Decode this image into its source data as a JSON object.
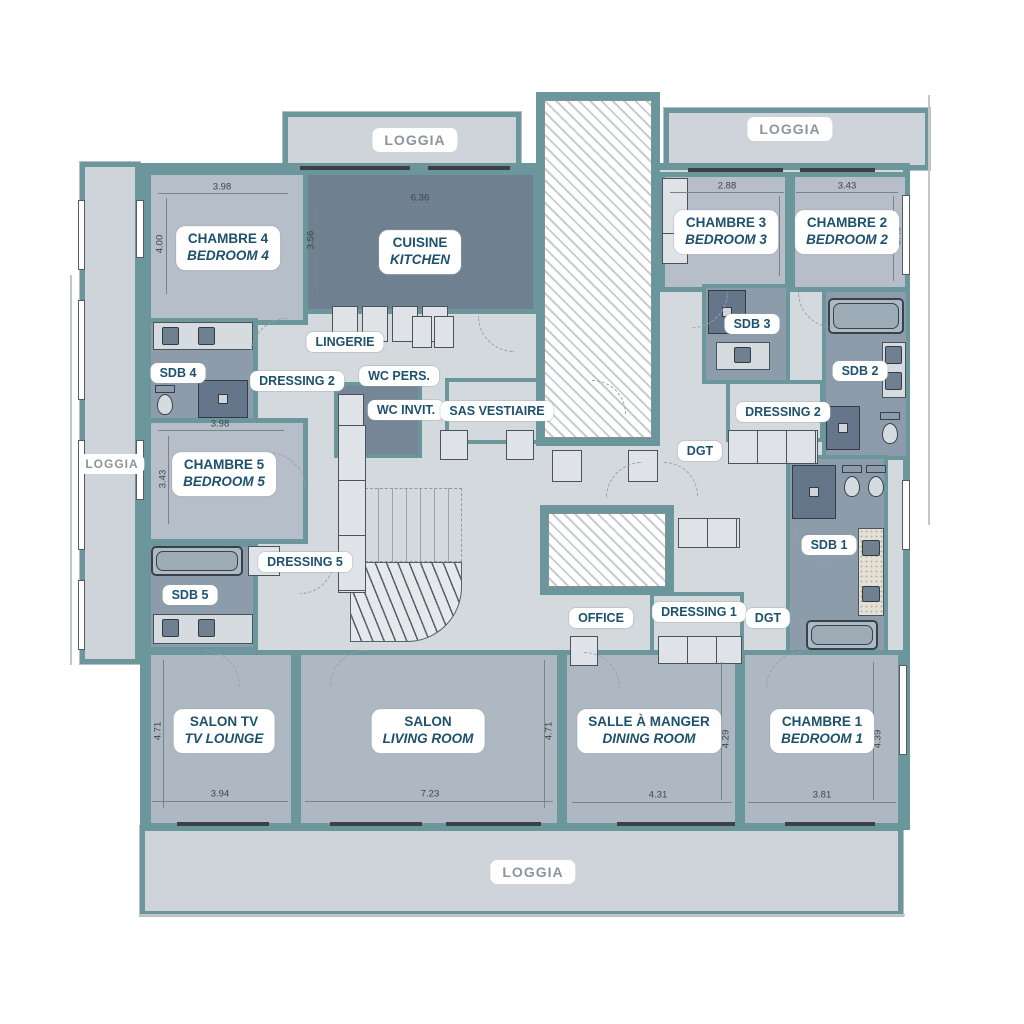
{
  "document": {
    "type": "apartment-floor-plan",
    "languages": "FR/EN"
  },
  "colors": {
    "wall": "#6a969c",
    "floor_corridor": "#d4d9de",
    "floor_bedroom": "#b5bec9",
    "floor_living": "#aeb8c3",
    "floor_kitchen": "#6f8090",
    "floor_bath": "#8d9cab",
    "floor_loggia": "#cfd4da",
    "room_label_text": "#1d516d",
    "loggia_label_text": "#8d949c",
    "dimension_text": "#3f464c"
  },
  "rooms": [
    {
      "id": "chambre-4",
      "name_fr": "CHAMBRE 4",
      "name_en": "BEDROOM 4",
      "width_m": "3.98",
      "height_m": "4.00"
    },
    {
      "id": "cuisine",
      "name_fr": "CUISINE",
      "name_en": "KITCHEN",
      "width_m": "6.36",
      "height_m": "3.56"
    },
    {
      "id": "chambre-3",
      "name_fr": "CHAMBRE 3",
      "name_en": "BEDROOM 3",
      "width_m": "2.88",
      "height_m": "2.80"
    },
    {
      "id": "chambre-2",
      "name_fr": "CHAMBRE 2",
      "name_en": "BEDROOM 2",
      "width_m": "3.43",
      "height_m": "3.40"
    },
    {
      "id": "chambre-5",
      "name_fr": "CHAMBRE 5",
      "name_en": "BEDROOM 5",
      "width_m": "3.98",
      "height_m": "3.43"
    },
    {
      "id": "salon-tv",
      "name_fr": "SALON TV",
      "name_en": "TV LOUNGE",
      "width_m": "3.94",
      "height_m": "4.71"
    },
    {
      "id": "salon",
      "name_fr": "SALON",
      "name_en": "LIVING ROOM",
      "width_m": "7.23",
      "height_m": "4.71"
    },
    {
      "id": "salle-a-manger",
      "name_fr": "SALLE À MANGER",
      "name_en": "DINING ROOM",
      "width_m": "4.31",
      "height_m": "4.29"
    },
    {
      "id": "chambre-1",
      "name_fr": "CHAMBRE 1",
      "name_en": "BEDROOM 1",
      "width_m": "3.81",
      "height_m": "4.39"
    }
  ],
  "service_labels": [
    {
      "label": "SDB 4"
    },
    {
      "label": "DRESSING 2"
    },
    {
      "label": "LINGERIE"
    },
    {
      "label": "WC PERS."
    },
    {
      "label": "WC INVIT."
    },
    {
      "label": "SAS VESTIAIRE"
    },
    {
      "label": "SDB 3"
    },
    {
      "label": "SDB 2"
    },
    {
      "label": "DRESSING 2"
    },
    {
      "label": "DGT"
    },
    {
      "label": "DRESSING 5"
    },
    {
      "label": "SDB 5"
    },
    {
      "label": "SDB 1"
    },
    {
      "label": "OFFICE"
    },
    {
      "label": "DRESSING 1"
    },
    {
      "label": "DGT"
    }
  ],
  "loggia_labels": [
    {
      "label": "LOGGIA"
    },
    {
      "label": "LOGGIA"
    },
    {
      "label": "LOGGIA"
    },
    {
      "label": "LOGGIA"
    }
  ],
  "fixtures": [
    "elevator-shaft",
    "staircase",
    "bathtub",
    "double-sink-vanity",
    "shower",
    "toilet",
    "wardrobe",
    "kitchen-counter",
    "door-swing"
  ]
}
